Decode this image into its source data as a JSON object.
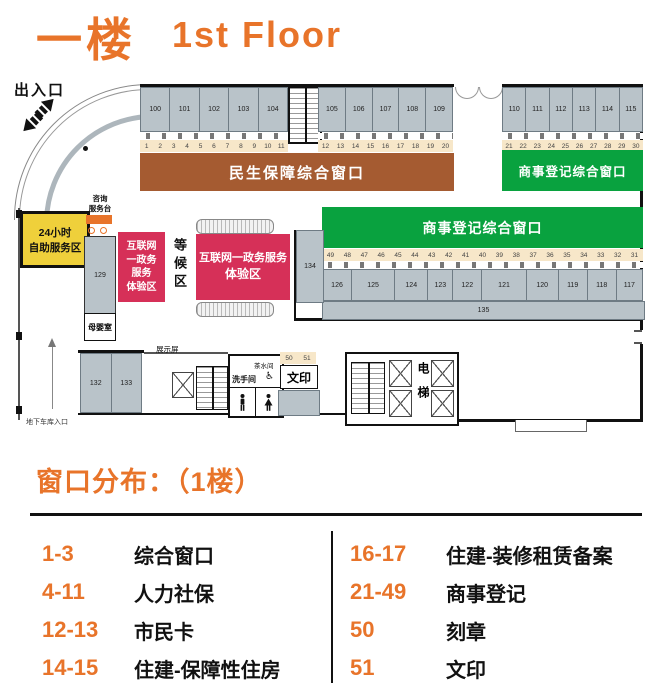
{
  "title": {
    "zh": "一楼",
    "en": "1st Floor"
  },
  "colors": {
    "accent_orange": "#E8742A",
    "banner_brown": "#A55B31",
    "banner_green": "#09A23F",
    "zone_red": "#D63058",
    "zone_yellow": "#EFD03B",
    "strip_cream": "#F7E7C9",
    "room_gray": "#B9C3C9"
  },
  "plan": {
    "entrance_label": "出入口",
    "garage_label": "地下车库入口",
    "consult_desk_lines": [
      "咨询",
      "服务台"
    ],
    "self_service_lines": [
      "24小时",
      "自助服务区"
    ],
    "waiting_area": "等候区",
    "internet_small_lines": [
      "互联网",
      "一政务",
      "服务",
      "体验区"
    ],
    "internet_large_lines": [
      "互联网一政务服务",
      "体验区"
    ],
    "banner_minsheng": "民生保障综合窗口",
    "banner_commerce_top": "商事登记综合窗口",
    "banner_commerce_mid": "商事登记综合窗口",
    "rooms_top_a": [
      "100",
      "101",
      "102",
      "103",
      "104"
    ],
    "rooms_top_b": [
      "105",
      "106",
      "107",
      "108",
      "109"
    ],
    "rooms_top_c": [
      "110",
      "111",
      "112",
      "113",
      "114",
      "115"
    ],
    "windows_a": [
      "1",
      "2",
      "3",
      "4",
      "5",
      "6",
      "7",
      "8",
      "9",
      "10",
      "11"
    ],
    "windows_b": [
      "12",
      "13",
      "14",
      "15",
      "16",
      "17",
      "18",
      "19",
      "20"
    ],
    "windows_c": [
      "21",
      "22",
      "23",
      "24",
      "25",
      "26",
      "27",
      "28",
      "29",
      "30"
    ],
    "windows_mid": [
      "49",
      "48",
      "47",
      "46",
      "45",
      "44",
      "43",
      "42",
      "41",
      "40",
      "39",
      "38",
      "37",
      "36",
      "35",
      "34",
      "33",
      "32",
      "31"
    ],
    "rooms_mid": [
      "126",
      "125",
      "124",
      "123",
      "122",
      "121",
      "120",
      "119",
      "118",
      "117"
    ],
    "room_134": "134",
    "room_135": "135",
    "room_129": "129",
    "rooms_bottom": [
      "132",
      "133"
    ],
    "mother_baby": "母婴室",
    "display_screen": "展示屏",
    "tea_room": "茶水间",
    "restroom": "洗手间",
    "print_label": "文印",
    "print_windows": [
      "50",
      "51"
    ],
    "elevator": "电梯"
  },
  "legend": {
    "title": "窗口分布：（1楼）",
    "left": [
      {
        "range": "1-3",
        "label": "综合窗口"
      },
      {
        "range": "4-11",
        "label": "人力社保"
      },
      {
        "range": "12-13",
        "label": "市民卡"
      },
      {
        "range": "14-15",
        "label": "住建-保障性住房"
      }
    ],
    "right": [
      {
        "range": "16-17",
        "label": "住建-装修租赁备案"
      },
      {
        "range": "21-49",
        "label": "商事登记"
      },
      {
        "range": "50",
        "label": "刻章"
      },
      {
        "range": "51",
        "label": "文印"
      }
    ]
  }
}
